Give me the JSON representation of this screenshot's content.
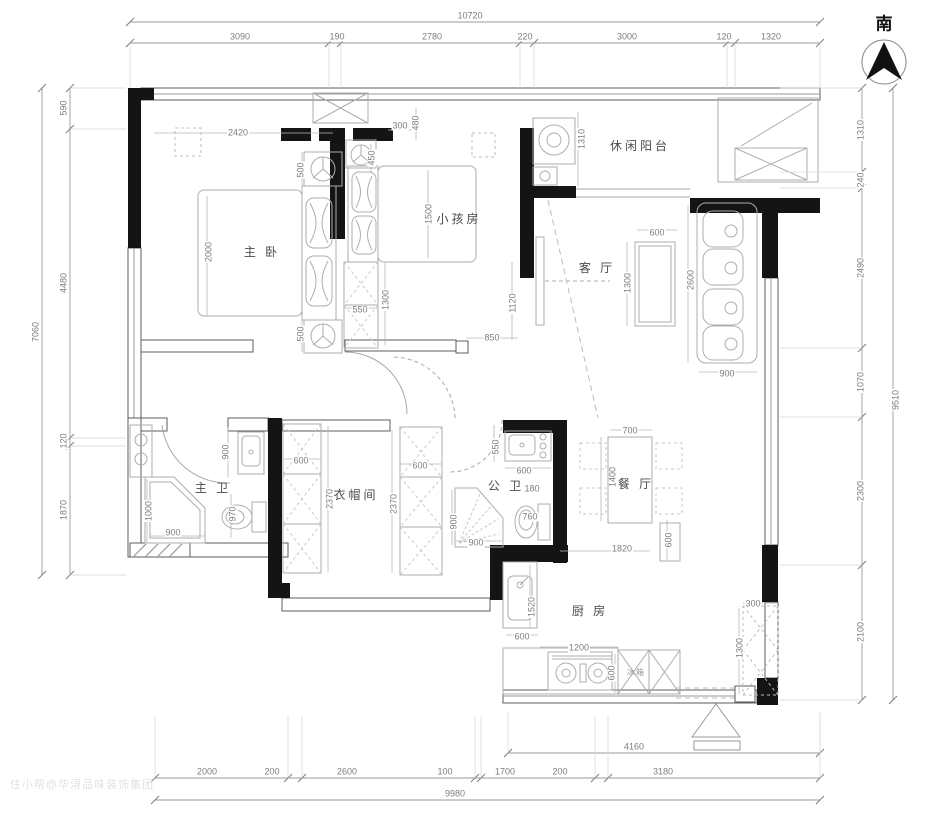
{
  "compass": {
    "label": "南"
  },
  "watermark": {
    "text": "住小帮@华浔品味装饰集团"
  },
  "rooms": [
    {
      "text": "主 卧",
      "x": 262,
      "y": 252,
      "rot": 0
    },
    {
      "text": "小孩房",
      "x": 459,
      "y": 219,
      "rot": 0
    },
    {
      "text": "休闲阳台",
      "x": 640,
      "y": 146,
      "rot": 0
    },
    {
      "text": "客 厅",
      "x": 597,
      "y": 268,
      "rot": 0
    },
    {
      "text": "主 卫",
      "x": 213,
      "y": 488,
      "rot": 0
    },
    {
      "text": "衣帽间",
      "x": 356,
      "y": 495,
      "rot": 0
    },
    {
      "text": "公 卫",
      "x": 506,
      "y": 486,
      "rot": 0
    },
    {
      "text": "餐 厅",
      "x": 636,
      "y": 484,
      "rot": 0
    },
    {
      "text": "厨 房",
      "x": 590,
      "y": 611,
      "rot": 0
    }
  ],
  "appliance_labels": [
    {
      "text": "冰箱",
      "x": 636,
      "y": 673,
      "rot": 0
    }
  ],
  "dimensions": {
    "ruler_labels": [
      {
        "text": "10720",
        "x": 470,
        "y": 16,
        "rot": 0
      },
      {
        "text": "3090",
        "x": 240,
        "y": 37,
        "rot": 0
      },
      {
        "text": "190",
        "x": 337,
        "y": 37,
        "rot": 0
      },
      {
        "text": "2780",
        "x": 432,
        "y": 37,
        "rot": 0
      },
      {
        "text": "220",
        "x": 525,
        "y": 37,
        "rot": 0
      },
      {
        "text": "3000",
        "x": 627,
        "y": 37,
        "rot": 0
      },
      {
        "text": "120",
        "x": 724,
        "y": 37,
        "rot": 0
      },
      {
        "text": "1320",
        "x": 771,
        "y": 37,
        "rot": 0
      },
      {
        "text": "7060",
        "x": 36,
        "y": 332,
        "rot": -90
      },
      {
        "text": "590",
        "x": 64,
        "y": 108,
        "rot": -90
      },
      {
        "text": "4480",
        "x": 64,
        "y": 283,
        "rot": -90
      },
      {
        "text": "120",
        "x": 64,
        "y": 441,
        "rot": -90
      },
      {
        "text": "1870",
        "x": 64,
        "y": 510,
        "rot": -90
      },
      {
        "text": "9510",
        "x": 896,
        "y": 400,
        "rot": -90
      },
      {
        "text": "1310",
        "x": 861,
        "y": 130,
        "rot": -90
      },
      {
        "text": "240",
        "x": 861,
        "y": 180,
        "rot": -90
      },
      {
        "text": "2490",
        "x": 861,
        "y": 268,
        "rot": -90
      },
      {
        "text": "1070",
        "x": 861,
        "y": 382,
        "rot": -90
      },
      {
        "text": "2300",
        "x": 861,
        "y": 491,
        "rot": -90
      },
      {
        "text": "2100",
        "x": 861,
        "y": 632,
        "rot": -90
      },
      {
        "text": "4160",
        "x": 634,
        "y": 747,
        "rot": 0
      },
      {
        "text": "2000",
        "x": 207,
        "y": 772,
        "rot": 0
      },
      {
        "text": "200",
        "x": 272,
        "y": 772,
        "rot": 0
      },
      {
        "text": "2600",
        "x": 347,
        "y": 772,
        "rot": 0
      },
      {
        "text": "100",
        "x": 445,
        "y": 772,
        "rot": 0
      },
      {
        "text": "1700",
        "x": 505,
        "y": 772,
        "rot": 0
      },
      {
        "text": "200",
        "x": 560,
        "y": 772,
        "rot": 0
      },
      {
        "text": "3180",
        "x": 663,
        "y": 772,
        "rot": 0
      },
      {
        "text": "9980",
        "x": 455,
        "y": 794,
        "rot": 0
      }
    ],
    "inner_labels": [
      {
        "text": "2420",
        "x": 238,
        "y": 133,
        "rot": 0
      },
      {
        "text": "2000",
        "x": 209,
        "y": 252,
        "rot": -90
      },
      {
        "text": "500",
        "x": 301,
        "y": 170,
        "rot": -90
      },
      {
        "text": "500",
        "x": 301,
        "y": 334,
        "rot": -90
      },
      {
        "text": "300",
        "x": 400,
        "y": 126,
        "rot": 0
      },
      {
        "text": "480",
        "x": 416,
        "y": 123,
        "rot": -90
      },
      {
        "text": "450",
        "x": 372,
        "y": 158,
        "rot": -90
      },
      {
        "text": "1500",
        "x": 429,
        "y": 214,
        "rot": -90
      },
      {
        "text": "550",
        "x": 360,
        "y": 310,
        "rot": 0
      },
      {
        "text": "1300",
        "x": 386,
        "y": 300,
        "rot": -90
      },
      {
        "text": "1120",
        "x": 513,
        "y": 303,
        "rot": -90
      },
      {
        "text": "850",
        "x": 492,
        "y": 338,
        "rot": 0
      },
      {
        "text": "1310",
        "x": 582,
        "y": 139,
        "rot": -90
      },
      {
        "text": "600",
        "x": 657,
        "y": 233,
        "rot": 0
      },
      {
        "text": "1300",
        "x": 628,
        "y": 283,
        "rot": -90
      },
      {
        "text": "2600",
        "x": 691,
        "y": 280,
        "rot": -90
      },
      {
        "text": "900",
        "x": 727,
        "y": 374,
        "rot": 0
      },
      {
        "text": "900",
        "x": 226,
        "y": 452,
        "rot": -90
      },
      {
        "text": "1000",
        "x": 149,
        "y": 511,
        "rot": -90
      },
      {
        "text": "900",
        "x": 173,
        "y": 533,
        "rot": 0
      },
      {
        "text": "970",
        "x": 233,
        "y": 514,
        "rot": -90
      },
      {
        "text": "600",
        "x": 301,
        "y": 461,
        "rot": 0
      },
      {
        "text": "2370",
        "x": 330,
        "y": 499,
        "rot": -90
      },
      {
        "text": "600",
        "x": 420,
        "y": 466,
        "rot": 0
      },
      {
        "text": "2370",
        "x": 394,
        "y": 504,
        "rot": -90
      },
      {
        "text": "550",
        "x": 496,
        "y": 447,
        "rot": -90
      },
      {
        "text": "600",
        "x": 524,
        "y": 471,
        "rot": 0
      },
      {
        "text": "180",
        "x": 532,
        "y": 489,
        "rot": 0
      },
      {
        "text": "760",
        "x": 530,
        "y": 517,
        "rot": 0
      },
      {
        "text": "900",
        "x": 454,
        "y": 522,
        "rot": -90
      },
      {
        "text": "900",
        "x": 476,
        "y": 543,
        "rot": 0
      },
      {
        "text": "700",
        "x": 630,
        "y": 431,
        "rot": 0
      },
      {
        "text": "1400",
        "x": 613,
        "y": 477,
        "rot": -90
      },
      {
        "text": "600",
        "x": 669,
        "y": 540,
        "rot": -90
      },
      {
        "text": "1820",
        "x": 622,
        "y": 549,
        "rot": 0
      },
      {
        "text": "1520",
        "x": 532,
        "y": 607,
        "rot": -90
      },
      {
        "text": "600",
        "x": 522,
        "y": 637,
        "rot": 0
      },
      {
        "text": "1200",
        "x": 579,
        "y": 648,
        "rot": 0
      },
      {
        "text": "600",
        "x": 612,
        "y": 673,
        "rot": -90
      },
      {
        "text": "300",
        "x": 753,
        "y": 604,
        "rot": 0
      },
      {
        "text": "1300",
        "x": 740,
        "y": 648,
        "rot": -90
      }
    ]
  },
  "rulers": [
    {
      "o": "h",
      "pos": 22,
      "from": 130,
      "to": 820,
      "ticks": [
        130,
        820
      ],
      "ext": null
    },
    {
      "o": "h",
      "pos": 43,
      "from": 130,
      "to": 820,
      "ticks": [
        130,
        329,
        341,
        520,
        534,
        727,
        735,
        820
      ],
      "ext": 88
    },
    {
      "o": "v",
      "pos": 42,
      "from": 88,
      "to": 575,
      "ticks": [
        88,
        575
      ],
      "ext": null
    },
    {
      "o": "v",
      "pos": 70,
      "from": 88,
      "to": 575,
      "ticks": [
        88,
        129,
        438,
        446,
        575
      ],
      "ext": 126
    },
    {
      "o": "v",
      "pos": 862,
      "from": 88,
      "to": 700,
      "ticks": [
        88,
        172,
        188,
        348,
        417,
        565,
        700
      ],
      "ext": 780
    },
    {
      "o": "v",
      "pos": 893,
      "from": 88,
      "to": 700,
      "ticks": [
        88,
        700
      ],
      "ext": null
    },
    {
      "o": "h",
      "pos": 753,
      "from": 508,
      "to": 820,
      "ticks": [
        508,
        820
      ],
      "ext": 712
    },
    {
      "o": "h",
      "pos": 778,
      "from": 155,
      "to": 820,
      "ticks": [
        155,
        288,
        302,
        475,
        481,
        595,
        608,
        820
      ],
      "ext": 716
    },
    {
      "o": "h",
      "pos": 800,
      "from": 155,
      "to": 820,
      "ticks": [
        155,
        820
      ],
      "ext": null
    }
  ]
}
